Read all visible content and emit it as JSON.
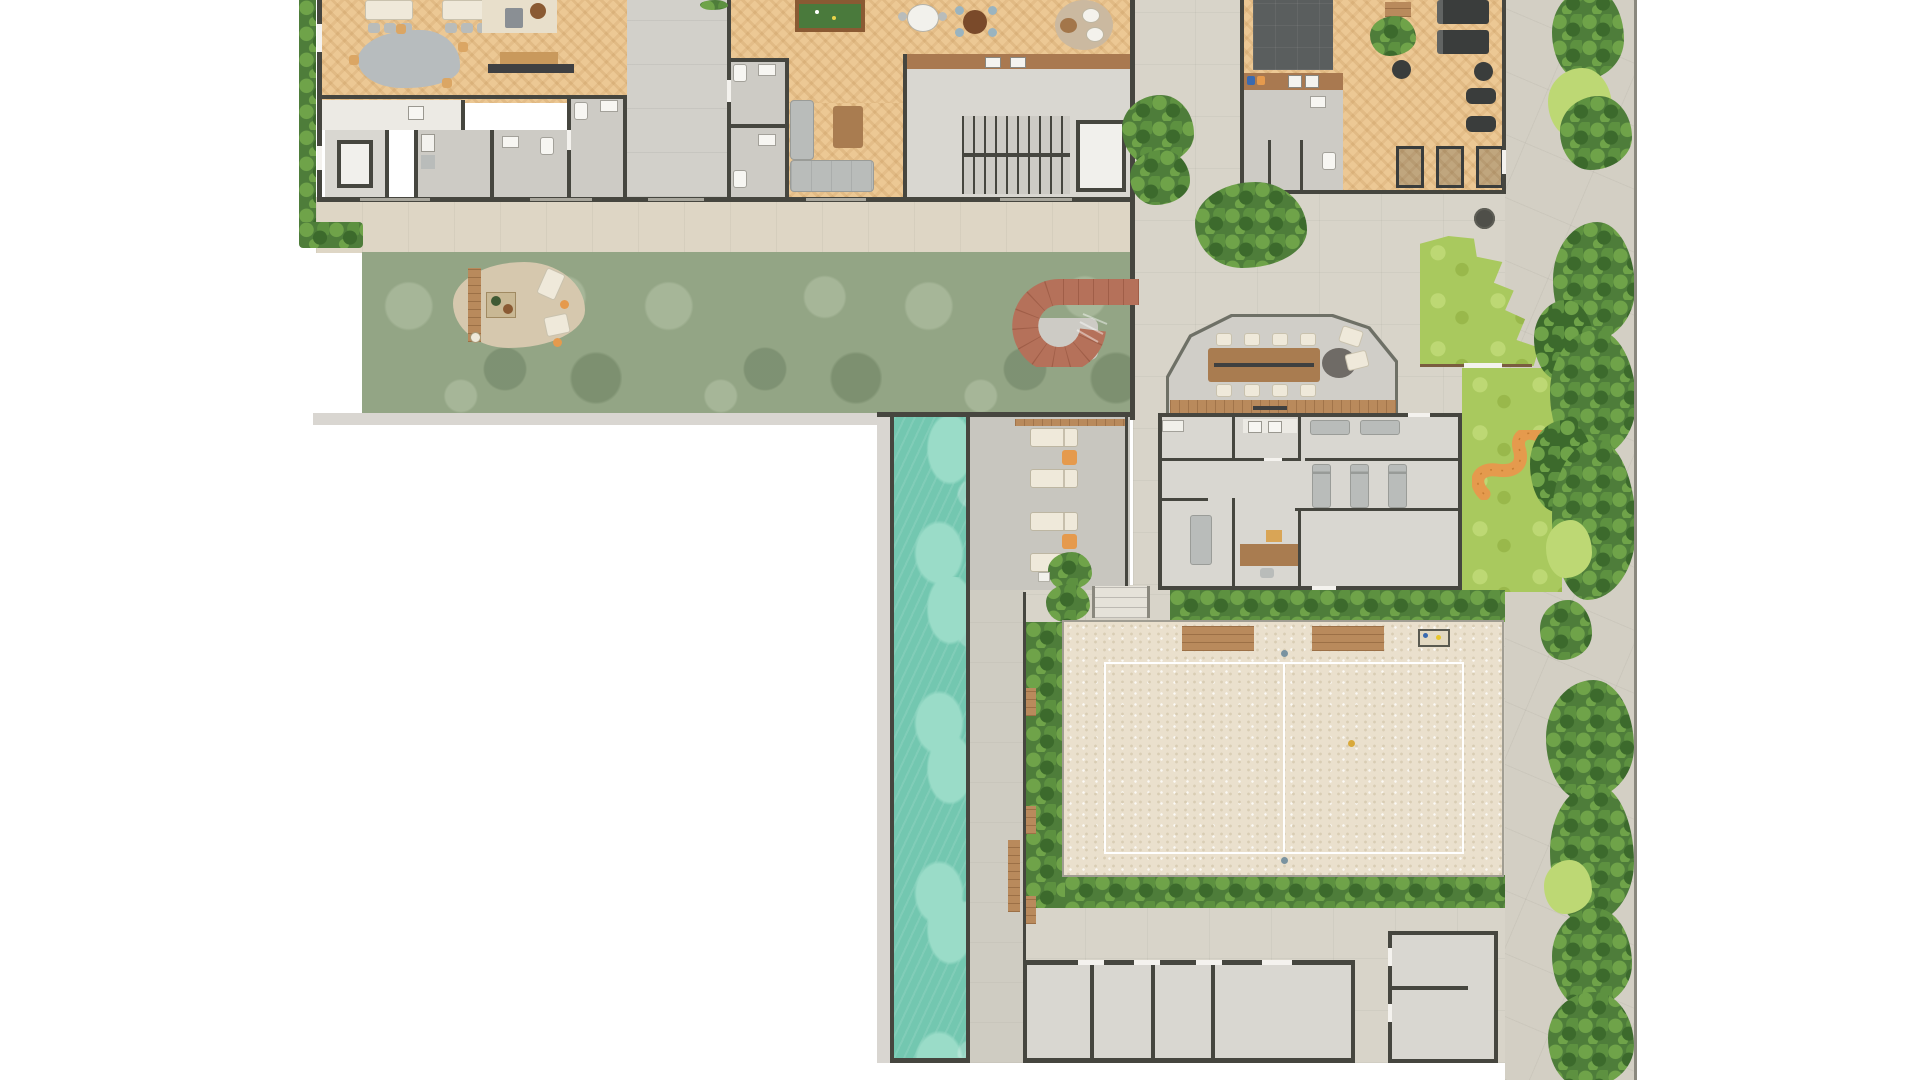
{
  "plan": {
    "kind": "architectural-floor-plan",
    "description": "Top-down ground-floor amenities plan: lounge building, gym, garden, spiral stair, meeting room, spa, lap pool with sun deck, beach sand court, lawns and perimeter hedges",
    "colors": {
      "wall": "#46463f",
      "wood": "#ecc894",
      "floor": "#d9d7d1",
      "floorDim": "#cdcbc5",
      "corridor": "#d2d0ca",
      "pavement": "#d8d4c9",
      "pavement2": "#d3cfc4",
      "walkway": "#ded6c5",
      "garden": "#93a585",
      "gardenLight": "#a6b698",
      "lawn": "#a9c95e",
      "lawnLight": "#bdd874",
      "hedge": "#4e7d3a",
      "hedgeLight": "#6fa349",
      "hedgeMid": "#5d9140",
      "hedgeDark": "#3c6a2c",
      "pool": "#73c7b0",
      "poolLight": "#9adcc8",
      "sand": "#eae0cd",
      "sandDot": "#d9cdb4",
      "courtLine": "#ffffff",
      "copper": "#b5715a",
      "orange": "#e59a4d",
      "deckWood": "#b98a5c",
      "counterWood": "#a97950",
      "cloud": "#b7bcbe",
      "cream": "#efe9da",
      "furnGray": "#b9bcba",
      "billiard": "#4a7a3c",
      "billiardWood": "#8a5a33",
      "mat": "#5a5e5e",
      "tableWood": "#a97c50",
      "deckGray": "#c8c6bf",
      "deckGreige": "#cfccc2",
      "borderStrip": "#d9d6d1",
      "glassWall": "#6e7066",
      "chairBlue": "#9ab4c0",
      "tableBrown": "#7a4a2a",
      "rugBeige": "#cbb9a0"
    },
    "areas": [
      {
        "id": "lounge-great-room"
      },
      {
        "id": "dining-area"
      },
      {
        "id": "games-room"
      },
      {
        "id": "service-kitchen"
      },
      {
        "id": "elevator"
      },
      {
        "id": "bathrooms"
      },
      {
        "id": "corridor"
      },
      {
        "id": "stair-core"
      },
      {
        "id": "bar-counter"
      },
      {
        "id": "gym"
      },
      {
        "id": "gym-mat-zone"
      },
      {
        "id": "gym-bathroom"
      },
      {
        "id": "garden"
      },
      {
        "id": "garden-patio"
      },
      {
        "id": "spiral-stair"
      },
      {
        "id": "meeting-room"
      },
      {
        "id": "spa-massage-rooms"
      },
      {
        "id": "office"
      },
      {
        "id": "lap-pool"
      },
      {
        "id": "sun-deck"
      },
      {
        "id": "beach-sand-court"
      },
      {
        "id": "kids-lawn"
      },
      {
        "id": "storage-rooms"
      },
      {
        "id": "perimeter-hedges"
      },
      {
        "id": "stone-path"
      }
    ],
    "counts": {
      "sun_loungers": 4,
      "meeting_chairs": 8,
      "massage_beds_vertical": 3,
      "massage_beds_horizontal": 2,
      "treadmills": 2,
      "spin_bikes": 2,
      "weight_stations": 3,
      "beach_court_platforms": 2,
      "storage_rooms": 4
    }
  }
}
